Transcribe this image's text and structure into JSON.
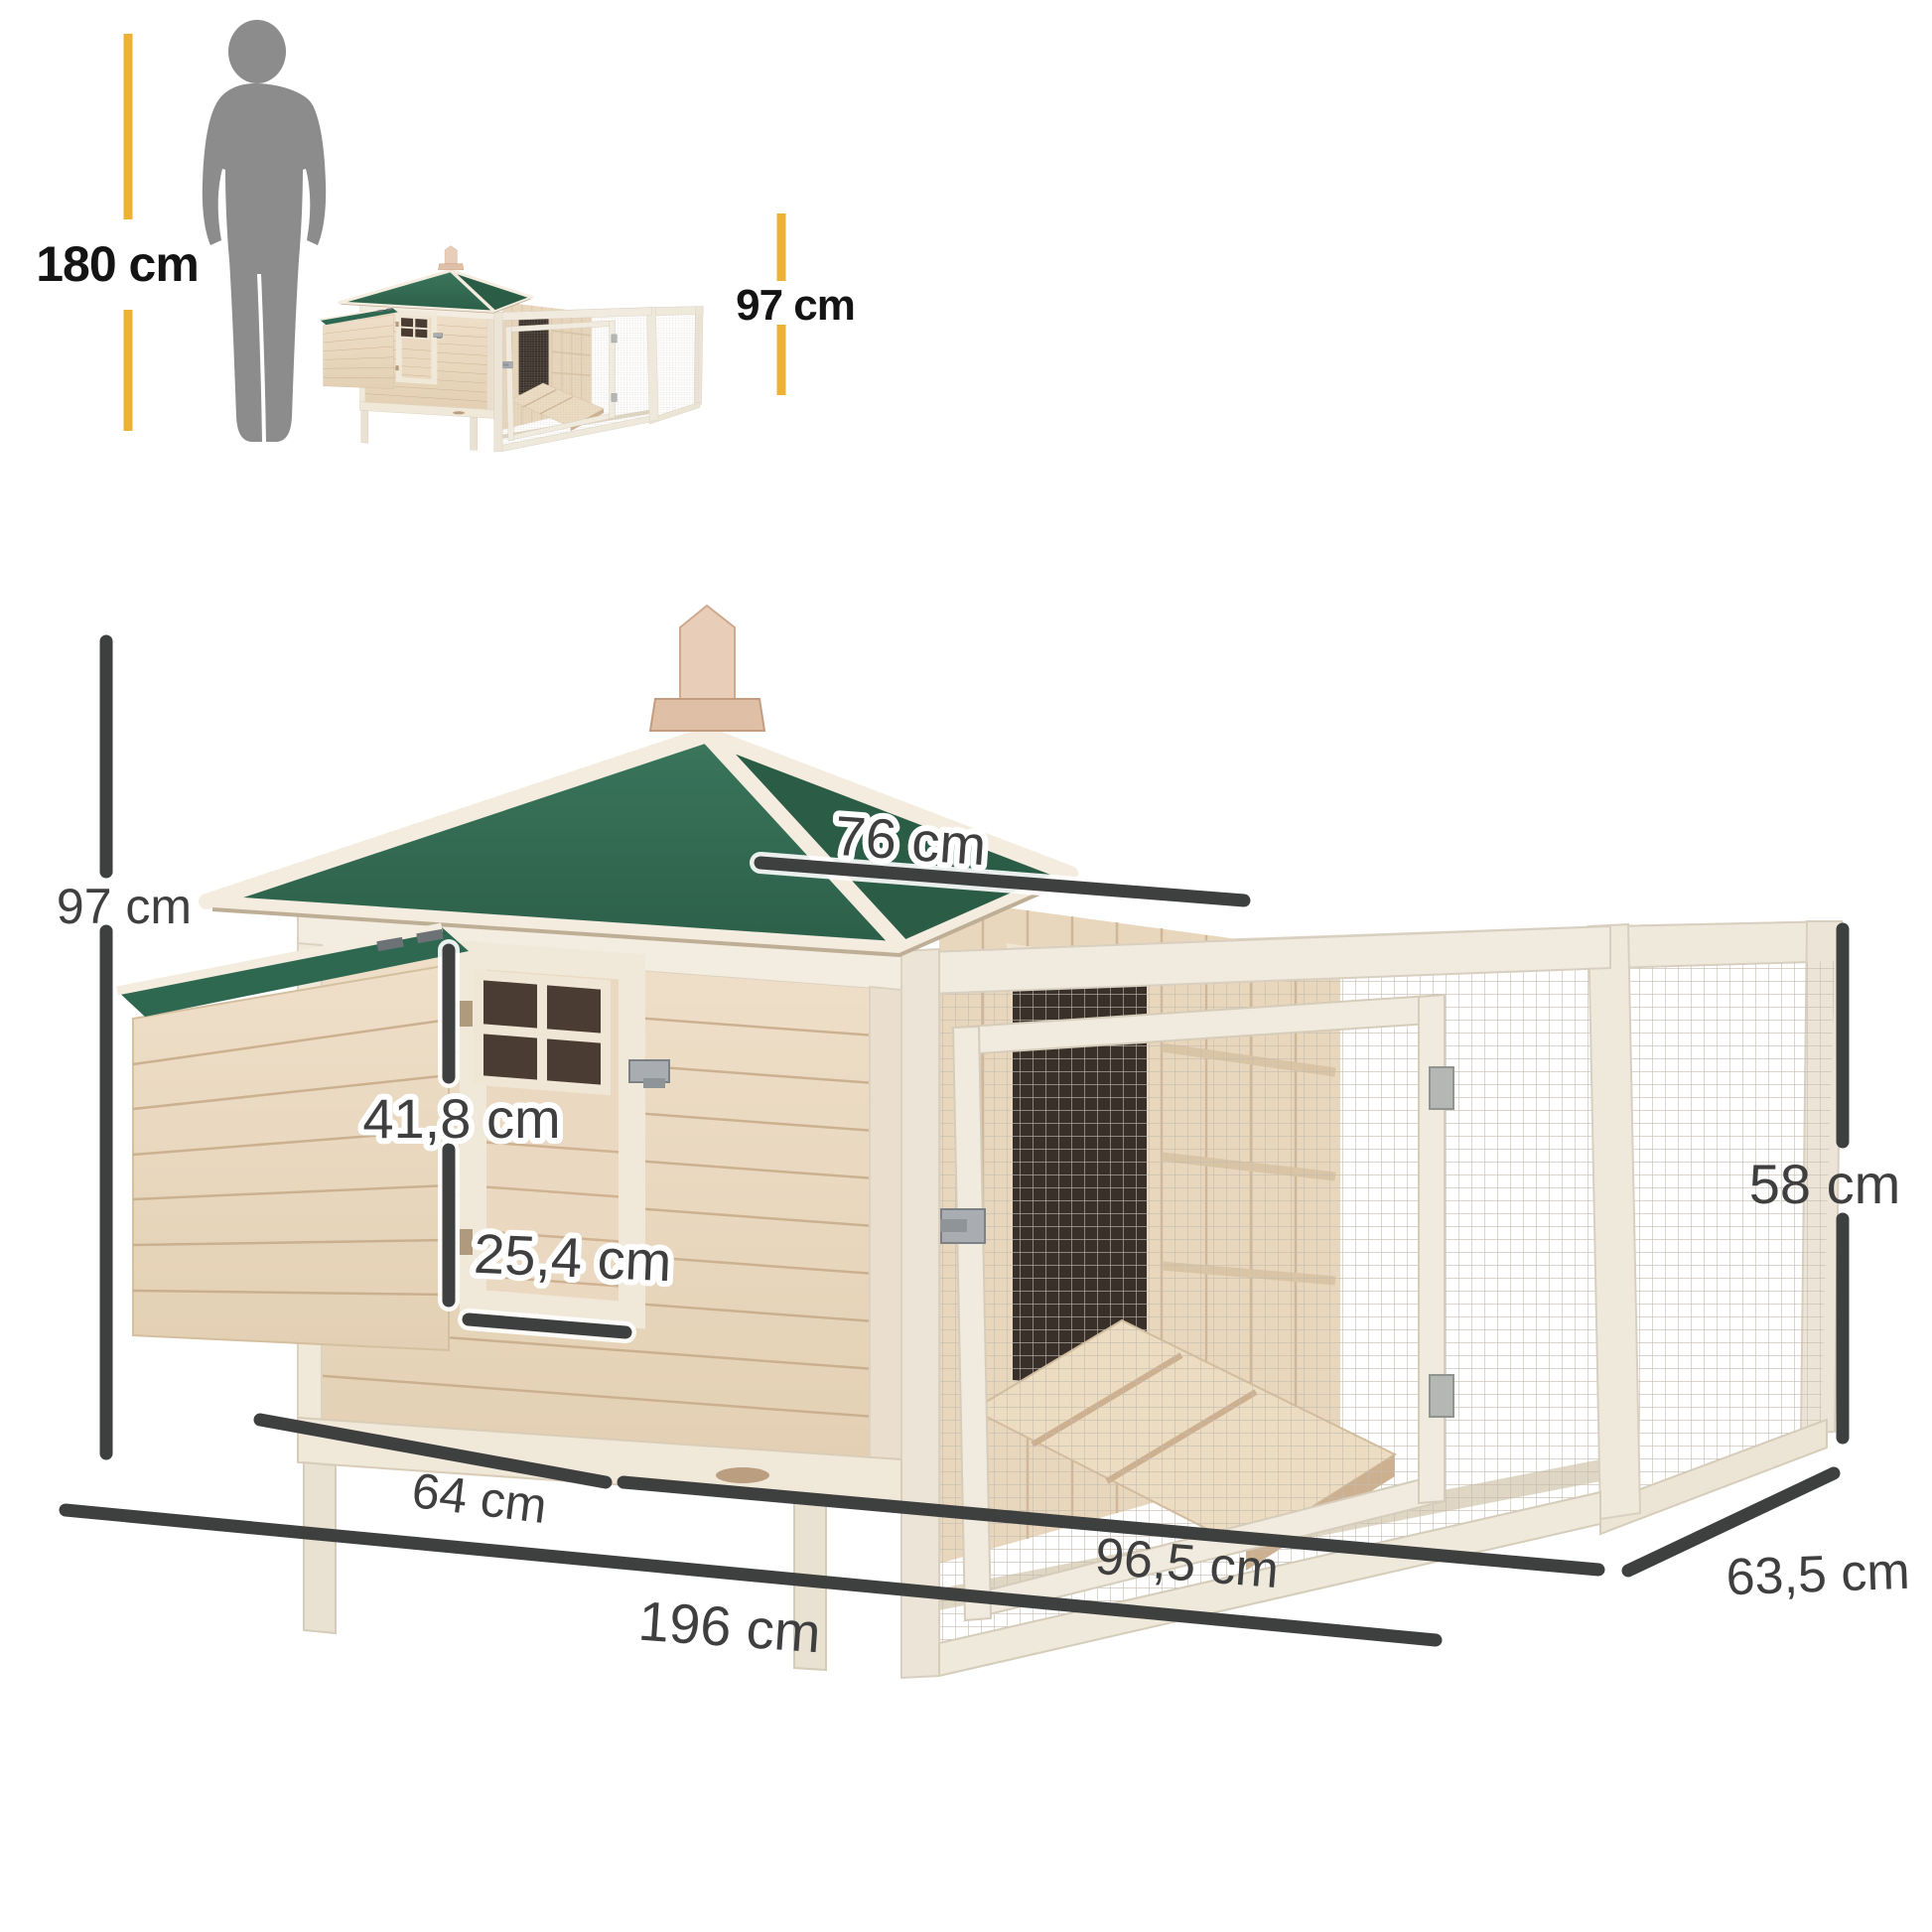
{
  "labels": {
    "person_height": "180 cm",
    "thumb_coop_height": "97 cm",
    "total_height": "97 cm",
    "roof_width": "76 cm",
    "door_height": "41,8 cm",
    "door_width": "25,4 cm",
    "run_height": "58 cm",
    "house_depth": "64 cm",
    "run_length": "96,5 cm",
    "total_length": "196 cm",
    "run_depth": "63,5 cm"
  },
  "colors": {
    "accent_yellow": "#EDB233",
    "dimension_line": "#3E3F3F",
    "label_text": "#3F3F3F",
    "heading_text": "#141414",
    "silhouette_gray": "#8C8C8C",
    "roof_green": "#346D53",
    "roof_green_dark": "#2B5C46",
    "wood_light": "#EBDCC4",
    "wood_trim": "#F0EADF"
  }
}
